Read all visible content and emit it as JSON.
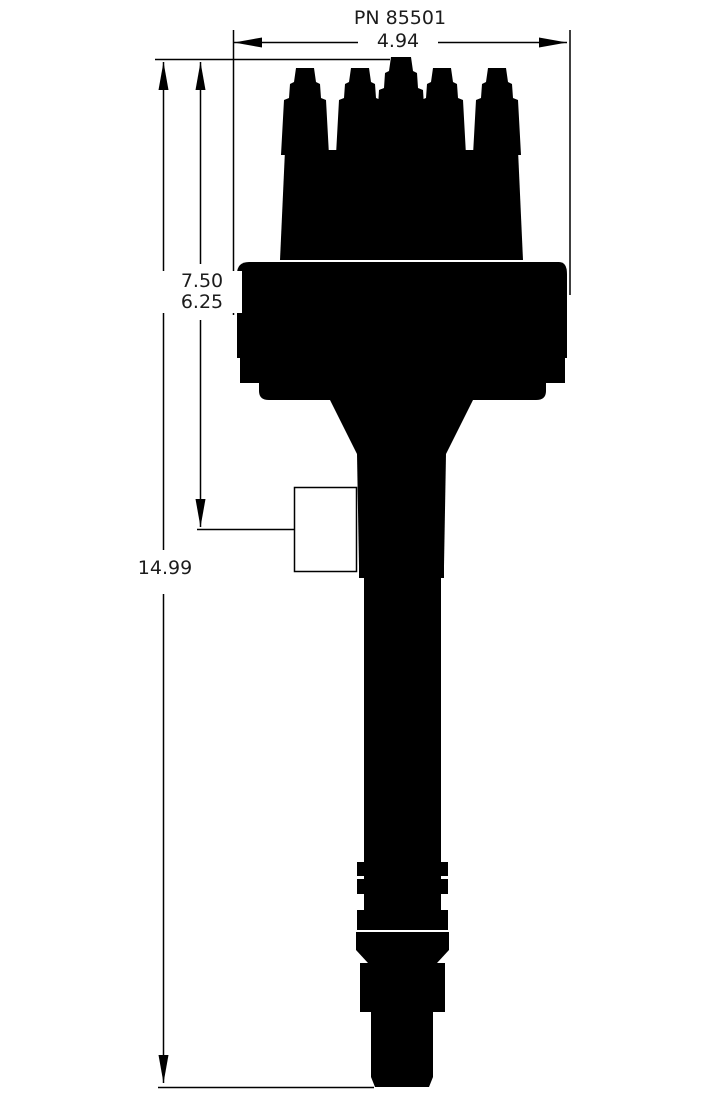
{
  "title": "PN 85501",
  "dimensions": {
    "width_in": "4.94",
    "cap_height_in": "7.50",
    "body_height_in": "6.25",
    "overall_height_in": "14.99"
  },
  "colors": {
    "ink": "#000000",
    "paper": "#ffffff",
    "label_text": "#1c1c1c"
  }
}
